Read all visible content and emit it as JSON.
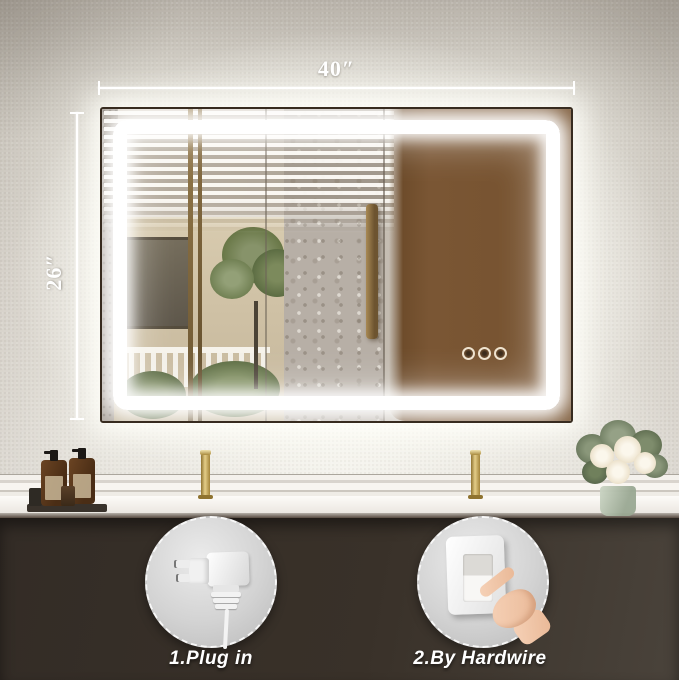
{
  "annotations": {
    "width_label": "40″",
    "height_label": "26″"
  },
  "callouts": [
    {
      "label": "1.Plug in",
      "icon": "power-plug-icon"
    },
    {
      "label": "2.By Hardwire",
      "icon": "wall-switch-icon"
    }
  ],
  "mirror": {
    "touch_button_count": 3,
    "led_color": "#ffffff",
    "reflection_panel_color": "#76522f"
  },
  "scene": {
    "wall_color": "#c9c4bc",
    "counter_color": "#f7f4ef",
    "cabinet_color": "#3a332c",
    "faucet_color": "#b5933f",
    "text_color": "#ffffff"
  }
}
